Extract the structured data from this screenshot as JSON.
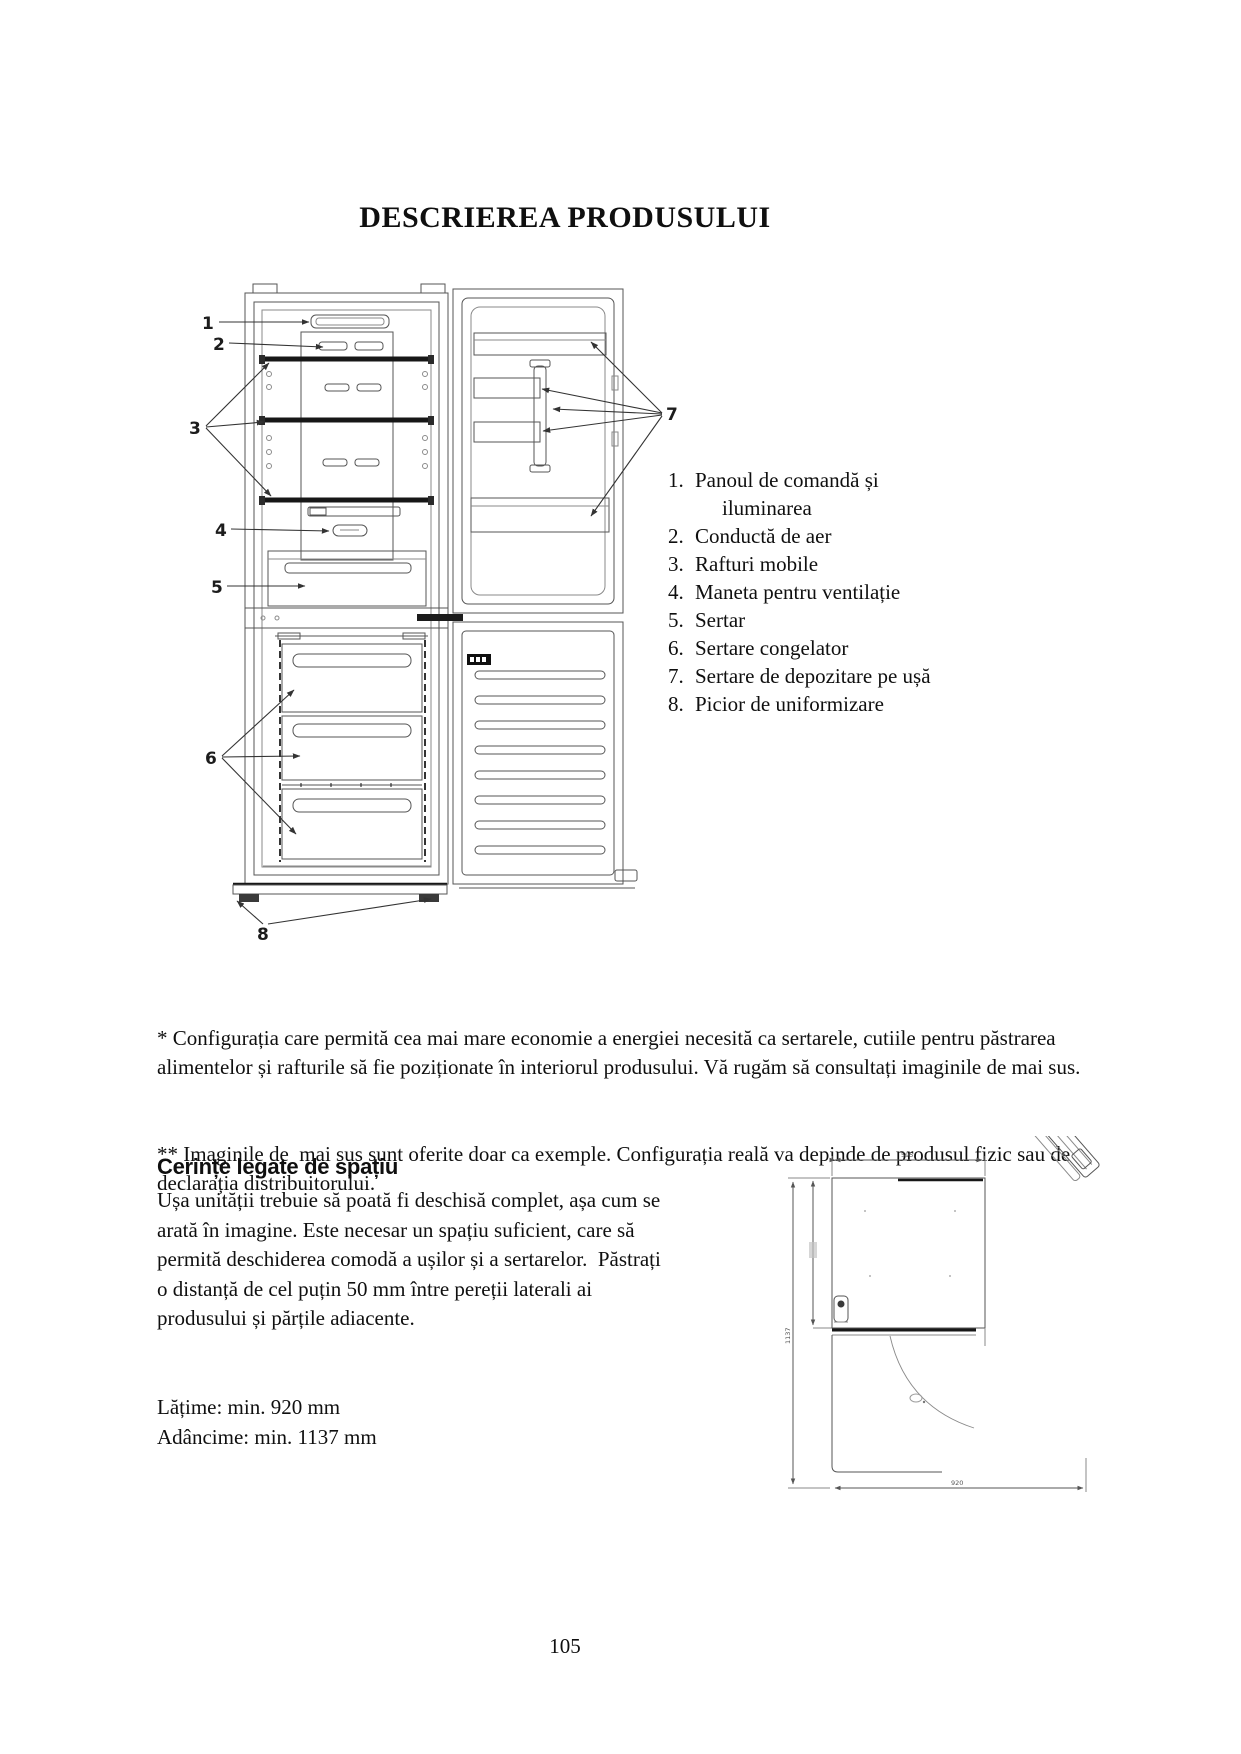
{
  "title": "DESCRIEREA PRODUSULUI",
  "figure": {
    "callouts": {
      "c1": "1",
      "c2": "2",
      "c3": "3",
      "c4": "4",
      "c5": "5",
      "c6": "6",
      "c7": "7",
      "c8": "8"
    }
  },
  "parts": {
    "items": [
      {
        "num": "1.",
        "label": "Panoul de comandă și iluminarea"
      },
      {
        "num": "2.",
        "label": "Conductă de aer"
      },
      {
        "num": "3.",
        "label": "Rafturi mobile"
      },
      {
        "num": "4.",
        "label": "Maneta pentru ventilație"
      },
      {
        "num": "5.",
        "label": "Sertar"
      },
      {
        "num": "6.",
        "label": "Sertare congelator"
      },
      {
        "num": "7.",
        "label": "Sertare de depozitare pe ușă"
      },
      {
        "num": "8.",
        "label": "Picior de uniformizare"
      }
    ]
  },
  "notes": {
    "note1": "* Configurația care permită cea mai mare economie a energiei necesită ca sertarele, cutiile pentru păstrarea alimentelor și rafturile să fie poziționate în interiorul produsului. Vă rugăm să consultați imaginile de mai sus.",
    "note2": "** Imaginile de  mai sus sunt oferite doar ca exemple. Configurația reală va depinde de produsul fizic sau de declarația distribuitorului."
  },
  "space": {
    "heading": "Cerințe legate de spațiu",
    "body": "Ușa unității trebuie să poată fi deschisă complet, așa cum se arată în imagine. Este necesar un spațiu suficient, care să permită deschiderea comodă a ușilor și a sertarelor.  Păstrați o distanță de cel puțin 50 mm între pereții laterali ai produsului și părțile adiacente.",
    "width_line": "Lățime: min. 920 mm",
    "depth_line": "Adâncime: min. 1137 mm"
  },
  "topview": {
    "width_label": "595",
    "depth_label": "1137",
    "clearance_label": "920"
  },
  "page_number": "105"
}
